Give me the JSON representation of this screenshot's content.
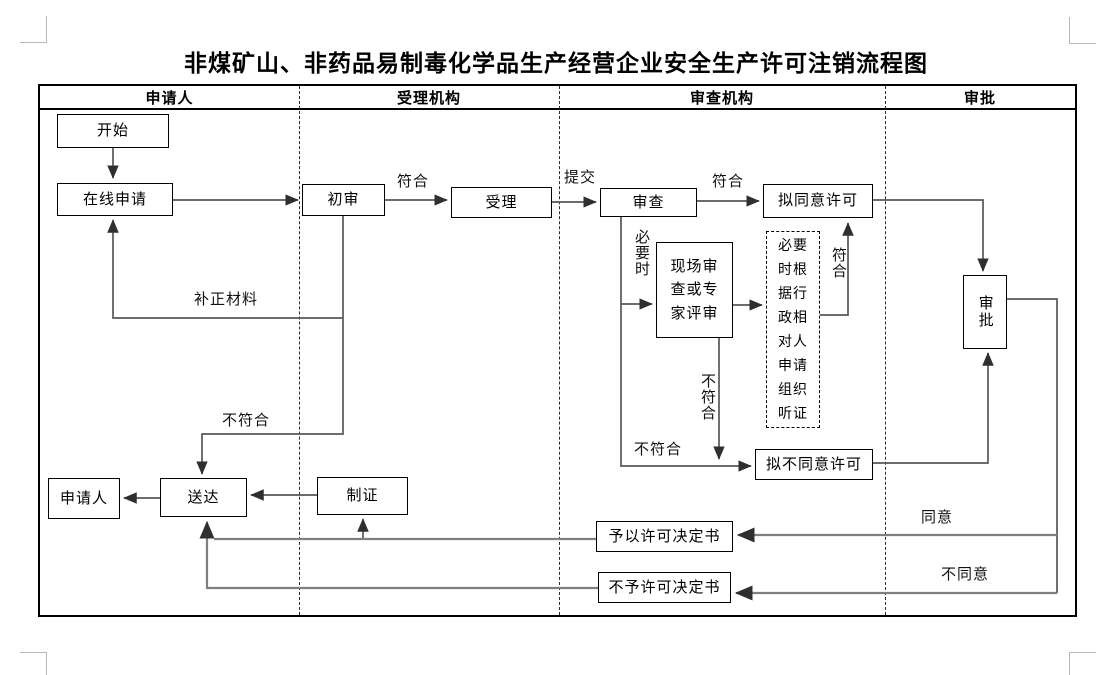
{
  "title": "非煤矿山、非药品易制毒化学品生产经营企业安全生产许可注销流程图",
  "columns": [
    {
      "label": "申请人"
    },
    {
      "label": "受理机构"
    },
    {
      "label": "审查机构"
    },
    {
      "label": "审批"
    }
  ],
  "nodes": {
    "start": "开始",
    "online_apply": "在线申请",
    "preliminary_review": "初审",
    "acceptance": "受理",
    "review": "审查",
    "onsite_review": "现场审查或专家评审",
    "hearing_note": "必要时根据行政相对人申请组织听证",
    "propose_approve": "拟同意许可",
    "propose_reject": "拟不同意许可",
    "approval": "审批",
    "applicant": "申请人",
    "delivery": "送达",
    "certificate": "制证",
    "grant_decision": "予以许可决定书",
    "deny_decision": "不予许可决定书"
  },
  "labels": {
    "conform_initial": "符合",
    "submit": "提交",
    "conform_review": "符合",
    "supplement_materials": "补正材料",
    "not_conform_initial": "不符合",
    "when_necessary": "必要时",
    "conform_hearing": "符合",
    "not_conform_onsite": "不符合",
    "not_conform_review": "不符合",
    "agree": "同意",
    "disagree": "不同意"
  },
  "colors": {
    "connector": "#575757",
    "return_line": "#7f7f7f",
    "border": "#000000"
  }
}
